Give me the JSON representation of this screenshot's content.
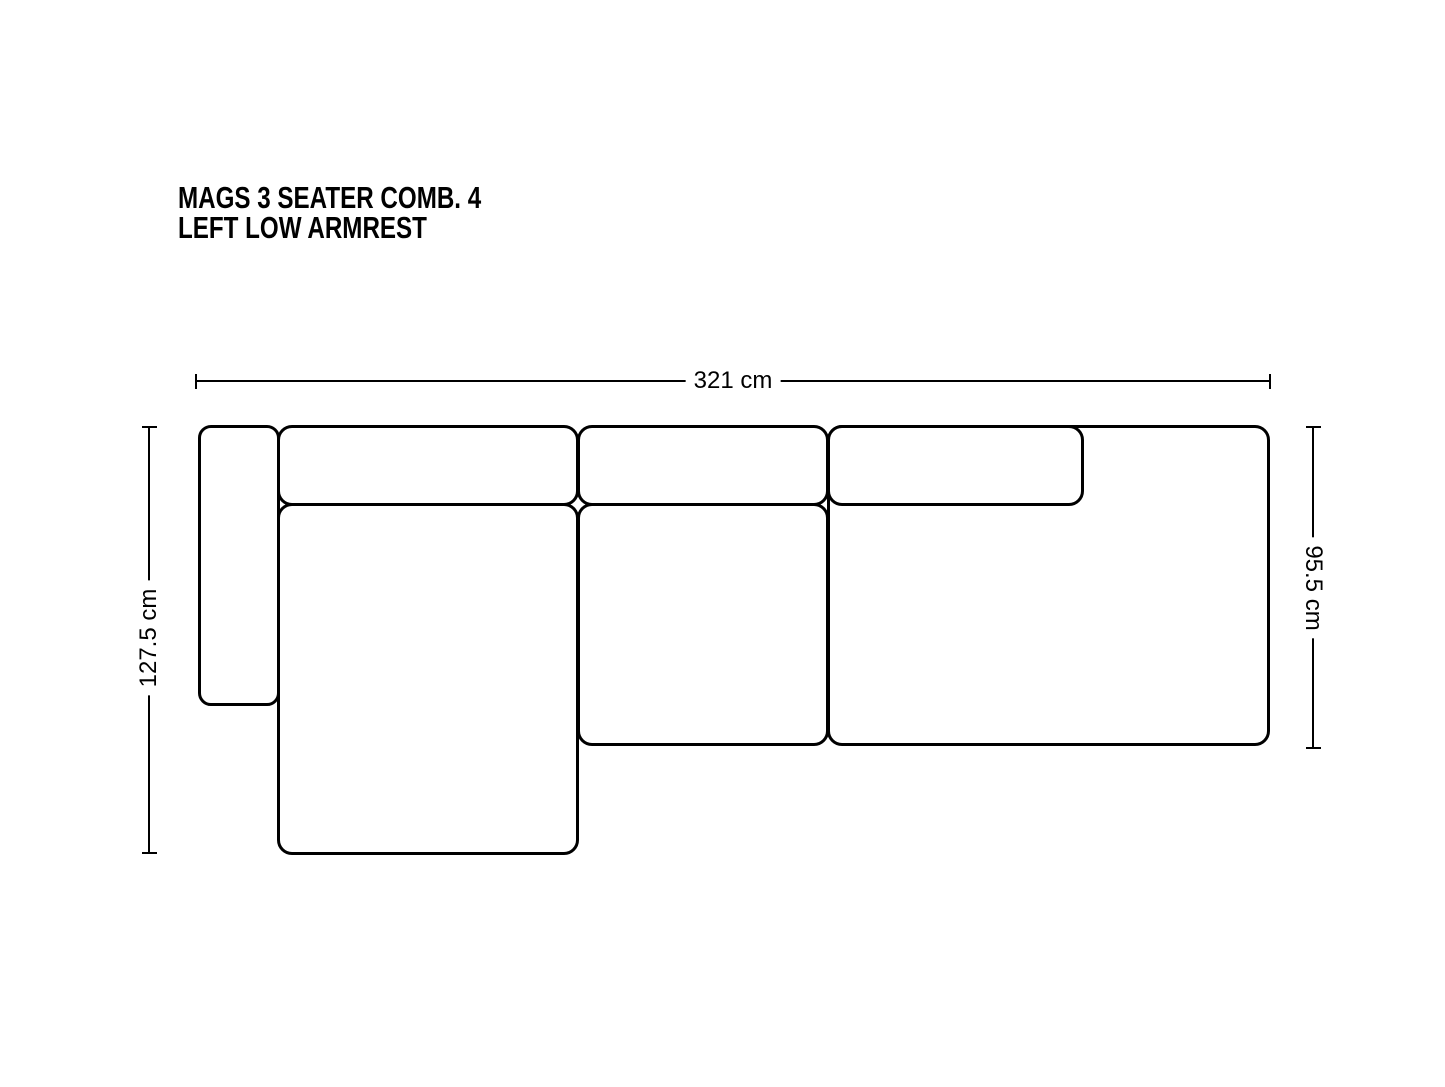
{
  "page": {
    "background_color": "#ffffff",
    "line_color": "#000000"
  },
  "title": {
    "line1": "MAGS 3 SEATER COMB. 4",
    "line2": "LEFT LOW ARMREST"
  },
  "diagram": {
    "type": "sofa-top-view-dimension-diagram",
    "dimensions": {
      "overall_width_label": "321 cm",
      "overall_depth_label": "127.5 cm",
      "right_section_depth_label": "95.5 cm"
    },
    "modules": [
      "left-low-armrest",
      "back-cushion-left",
      "back-cushion-middle",
      "back-cushion-right",
      "chaise-lounge-seat",
      "middle-seat",
      "right-seat-with-integrated-armrest"
    ]
  }
}
